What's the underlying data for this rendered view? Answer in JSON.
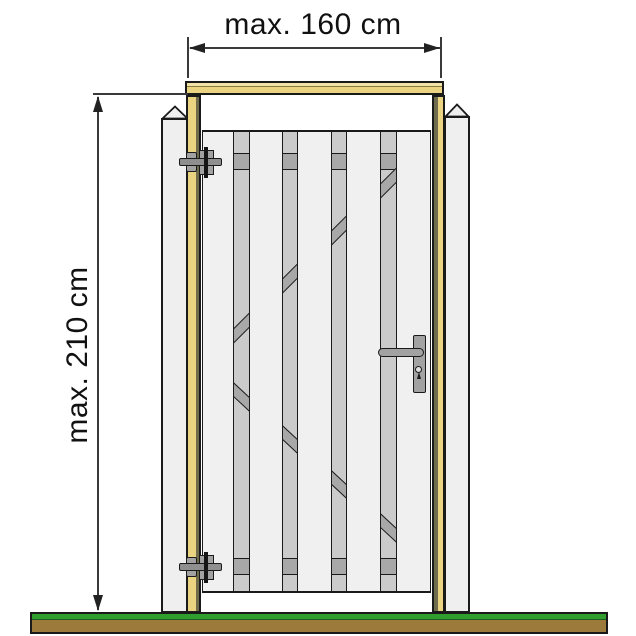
{
  "diagram": {
    "subject": "Wooden garden gate mounted in a timber frame between two concrete posts (front view)",
    "dimensions": {
      "width_label": "max. 160 cm",
      "height_label": "max. 210 cm"
    }
  },
  "gate": {
    "front_plank_count": 5,
    "gap_count": 4,
    "rails": [
      "top rail",
      "bottom rail"
    ],
    "braces": [
      "upper diagonal brace rising to the right",
      "lower diagonal brace falling to the right"
    ],
    "hardware": [
      "top hinge bolt",
      "bottom hinge bolt",
      "lock backplate with lever handle and keyhole"
    ]
  },
  "colors": {
    "frame-wood": "#EAD381",
    "frame-wood-light": "#F1E2A6",
    "frame-edge": "#6F6C4D",
    "concrete": "#EFEFEF",
    "plank": "#F0F0F0",
    "back-plank": "#CBCBCB",
    "brace": "#A8A8A8",
    "hardware": "#A2A2A2",
    "hardware-dark": "#8F8F8F",
    "outline": "#1A1A1A",
    "grass": "#2F9E2F",
    "soil": "#9C7A3C",
    "dim-line": "#3A3A3A",
    "text": "#111111"
  }
}
